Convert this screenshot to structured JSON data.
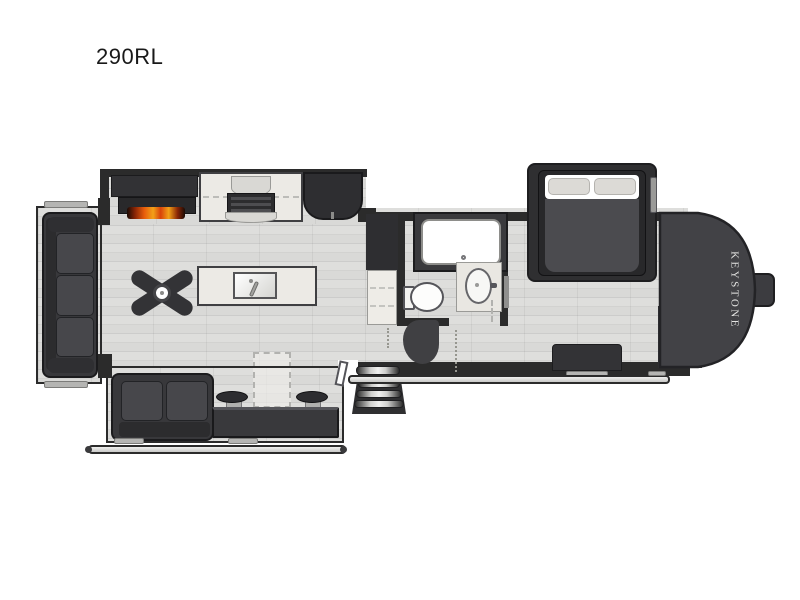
{
  "page": {
    "background": "#ffffff"
  },
  "plan": {
    "model_label": "290RL",
    "brand_label": "KEYSTONE",
    "type": "rv-fifth-wheel-floorplan"
  },
  "colors": {
    "wall": "#2b2b2b",
    "furniture_dark": "#38383b",
    "floor_plank": "#d9d9d7",
    "countertop": "#eceae5",
    "flame_orange": "#e8640d",
    "flame_yellow": "#f2a118",
    "mattress_gray": "#4b4b4f",
    "front_cap": "#424246",
    "awning_rail": "#d9d9d6",
    "brand_text": "#e4e4e2"
  },
  "features": [
    {
      "name": "rear-sofa-slideout",
      "label": "rear sofa in slide-out"
    },
    {
      "name": "entertainment-center",
      "label": "entertainment center"
    },
    {
      "name": "fireplace",
      "label": "fireplace"
    },
    {
      "name": "kitchen-counter",
      "label": "kitchen counter with range"
    },
    {
      "name": "refrigerator",
      "label": "refrigerator"
    },
    {
      "name": "kitchen-island-sink",
      "label": "kitchen island with sink"
    },
    {
      "name": "ceiling-fan",
      "label": "ceiling fan"
    },
    {
      "name": "pantry",
      "label": "pantry cabinet"
    },
    {
      "name": "shower",
      "label": "shower"
    },
    {
      "name": "toilet",
      "label": "toilet"
    },
    {
      "name": "vanity-sink",
      "label": "bathroom vanity sink"
    },
    {
      "name": "queen-bed-slideout",
      "label": "bed in slide-out"
    },
    {
      "name": "dresser",
      "label": "bedroom dresser"
    },
    {
      "name": "wardrobe",
      "label": "wardrobe closets"
    },
    {
      "name": "loveseat",
      "label": "loveseat in slide-out"
    },
    {
      "name": "counter-with-stools",
      "label": "counter with two stools"
    },
    {
      "name": "free-standing-table",
      "label": "free-standing table (dashed)"
    },
    {
      "name": "entry-steps",
      "label": "entry steps"
    },
    {
      "name": "entry-door",
      "label": "entry door"
    },
    {
      "name": "awning-rails",
      "label": "awning rails"
    }
  ]
}
